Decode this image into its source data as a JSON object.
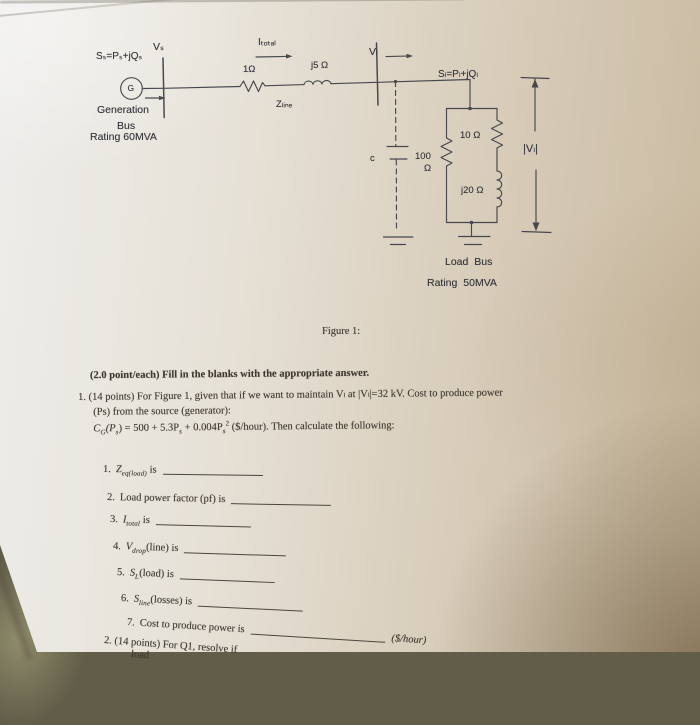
{
  "colors": {
    "paper_light": "#eeedeb",
    "paper_tan": "#c9baa0",
    "corner_shadow": "#4a3518",
    "surface_dark": "#615d48",
    "ink": "#3e3930",
    "circuit_ink": "#3d3e45"
  },
  "circuit": {
    "generator_letter": "G",
    "labels": {
      "source_power": "Sₛ=Pₛ+jQₛ",
      "source_voltage": "Vₛ",
      "current_total": "Iₜₒₜₐₗ",
      "line_resistor": "1Ω",
      "line_inductor": "j5 Ω",
      "line_impedance": "Zₗᵢₙₑ",
      "gen_bus_line1": "Generation",
      "gen_bus_line2": "Bus",
      "gen_bus_line3": "Rating 60MVA",
      "load_voltage": "Vₗ",
      "load_power": "Sₗ=Pₗ+jQₗ",
      "capacitor": "c",
      "load_resistor_series": "10 Ω",
      "shunt_resistor_value": "100",
      "shunt_resistor_unit": "Ω",
      "load_inductor": "j20 Ω",
      "load_voltage_magnitude": "|Vₗ|",
      "load_bus_line1": "Load Bus",
      "load_bus_line2": "Rating 50MVA"
    }
  },
  "figure": {
    "caption": "Figure 1:"
  },
  "instruction": "(2.0 point/each) Fill in the blanks with the appropriate answer.",
  "question1": {
    "intro_line1": "1. (14 points) For Figure 1, given that if we want to maintain Vₗ at |Vₗ|=32 kV. Cost to produce power",
    "intro_line2": "(Ps) from the source (generator):",
    "formula": {
      "p1": "C",
      "s1": "G",
      "p2": "(P",
      "s2": "s",
      "p3": ") = 500 + 5.3P",
      "s3": "s",
      "p4": " + 0.004P",
      "s4": "s",
      "sup2": "2",
      "p5": " ($/hour). Then calculate the following:"
    },
    "blanks": [
      {
        "num": "1.",
        "lead": "",
        "var": "Z",
        "sub": "eq(load)",
        "post": " is",
        "tail": ""
      },
      {
        "num": "2.",
        "lead": "Load power factor (pf) is",
        "var": "",
        "sub": "",
        "post": "",
        "tail": ""
      },
      {
        "num": "3.",
        "lead": "",
        "var": "I",
        "sub": "total",
        "post": " is",
        "tail": ""
      },
      {
        "num": "4.",
        "lead": "",
        "var": "V",
        "sub": "drop",
        "post": "(line) is",
        "tail": ""
      },
      {
        "num": "5.",
        "lead": "",
        "var": "S",
        "sub": "L",
        "post": "(load) is",
        "tail": ""
      },
      {
        "num": "6.",
        "lead": "",
        "var": "S",
        "sub": "line",
        "post": "(losses) is",
        "tail": ""
      },
      {
        "num": "7.",
        "lead": "Cost to produce power is",
        "var": "",
        "sub": "",
        "post": "",
        "tail": "($/hour)"
      }
    ]
  },
  "question2": {
    "line1": "2. (14 points) For Q1, resolve if",
    "next_line_fragment": "load"
  }
}
